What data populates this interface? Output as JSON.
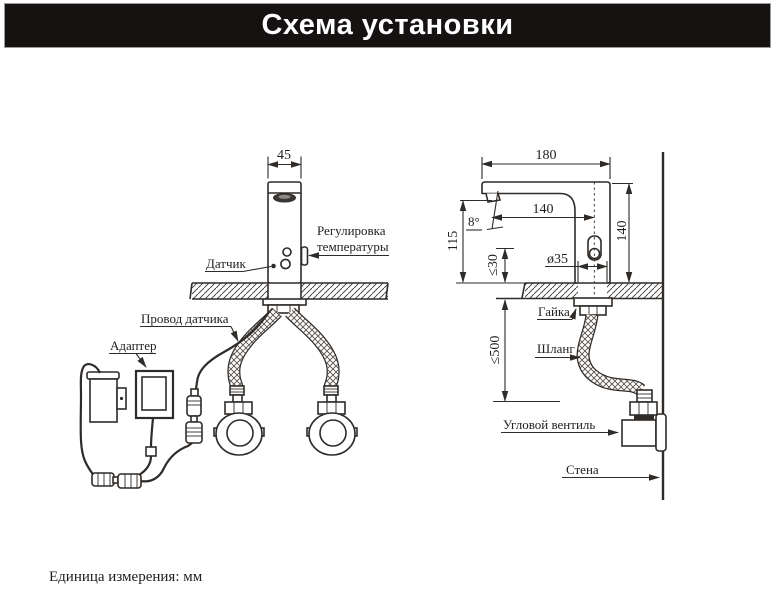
{
  "title": "Схема установки",
  "units_note": "Единица измерения: мм",
  "front_view": {
    "dim_width": "45",
    "sensor_label": "Датчик",
    "temp_label_line1": "Регулировка",
    "temp_label_line2": "температуры",
    "sensor_wire_label": "Провод датчика",
    "adapter_label": "Адаптер"
  },
  "side_view": {
    "dim_total_length": "180",
    "dim_spout_reach": "140",
    "dim_spout_height": "115",
    "dim_overall_height": "140",
    "dim_spout_angle": "8°",
    "dim_hole_diameter": "ø35",
    "dim_max_deck_thickness": "≤30",
    "dim_hose_length": "≤500",
    "nut_label": "Гайка",
    "hose_label": "Шланг",
    "angle_valve_label": "Угловой вентиль",
    "wall_label": "Стена"
  },
  "colors": {
    "line": "#2f2b28",
    "text": "#211e1b",
    "title_background": "#171212",
    "title_text": "#ffffff",
    "background": "#ffffff"
  }
}
